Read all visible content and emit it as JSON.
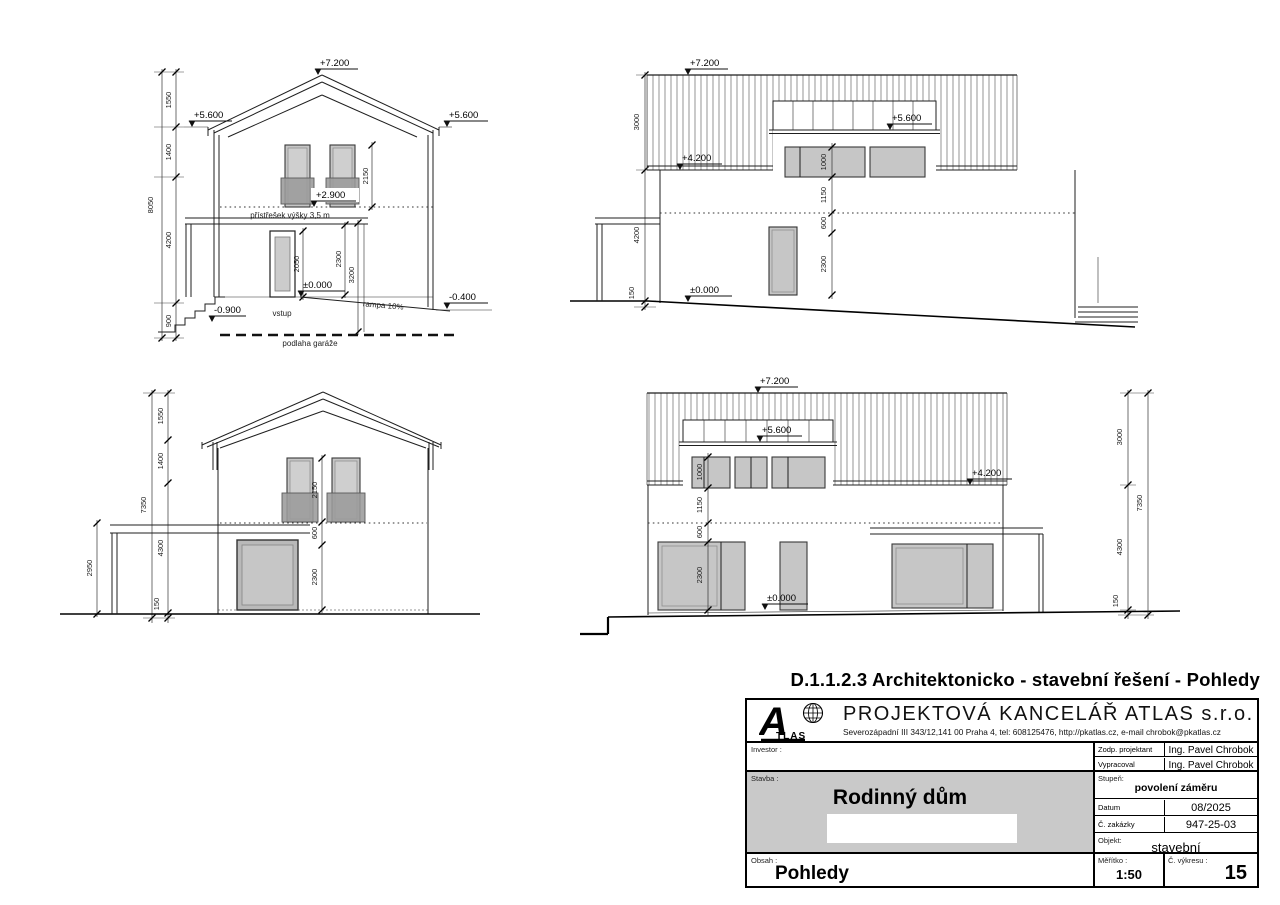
{
  "header": {
    "title": "D.1.1.2.3 Architektonicko - stavební řešení - Pohledy"
  },
  "views": {
    "front": {
      "levels": {
        "ridge": "+7.200",
        "eaves_left": "+5.600",
        "eaves_right": "+5.600",
        "balcony": "+2.900",
        "zero": "±0.000",
        "entry": "-0.900",
        "ramp_end": "-0.400"
      },
      "dims": {
        "overall": "8050",
        "chain": [
          "1550",
          "1400",
          "4200",
          "900"
        ],
        "window": "2150",
        "door": "2050",
        "opening": "2300",
        "ramp": "3200"
      },
      "labels": {
        "canopy": "přístřešek výšky 3,5 m",
        "entrance": "vstup",
        "ramp": "rampa 10%",
        "garage_floor": "podlaha garáže"
      }
    },
    "side_right": {
      "levels": {
        "ridge": "+7.200",
        "dormer": "+5.600",
        "eaves": "+4.200",
        "zero": "±0.000"
      },
      "dims": {
        "roof": "3000",
        "wall": "4200",
        "plinth": "150",
        "window": "1000",
        "parapet": "1150",
        "lintel": "600",
        "opening": "2300"
      }
    },
    "rear": {
      "dims": {
        "overall": "7350",
        "chain": [
          "1550",
          "1400",
          "4300",
          "150"
        ],
        "carport": "2950",
        "window": "2150",
        "lintel": "600",
        "opening": "2300"
      }
    },
    "side_left": {
      "levels": {
        "ridge": "+7.200",
        "dormer": "+5.600",
        "eaves": "+4.200",
        "zero": "±0.000"
      },
      "dims": {
        "roof": "3000",
        "overall": "7350",
        "wall": "4300",
        "plinth": "150",
        "window": "1000",
        "parapet": "1150",
        "lintel": "600",
        "opening": "2300"
      }
    }
  },
  "titleblock": {
    "company": "PROJEKTOVÁ  KANCELÁŘ ATLAS s.r.o.",
    "address": "Severozápadní III 343/12,141 00 Praha 4, tel: 608125476, http://pkatlas.cz, e-mail chrobok@pkatlas.cz",
    "logo": {
      "letter": "A",
      "rest": "TLAS"
    },
    "investor_label": "Investor :",
    "zodp_label": "Zodp. projektant",
    "zodp_value": "Ing. Pavel Chrobok",
    "vypracoval_label": "Vypracoval",
    "vypracoval_value": "Ing. Pavel Chrobok",
    "stavba_label": "Stavba :",
    "stavba_value": "Rodinný dům",
    "stupen_label": "Stupeň:",
    "stupen_value": "povolení záměru",
    "datum_label": "Datum",
    "datum_value": "08/2025",
    "zakazka_label": "Č. zakázky",
    "zakazka_value": "947-25-03",
    "objekt_label": "Objekt:",
    "objekt_value": "stavební",
    "obsah_label": "Obsah :",
    "obsah_value": "Pohledy",
    "meritko_label": "Měřítko :",
    "meritko_value": "1:50",
    "vykres_label": "Č. výkresu :",
    "vykres_value": "15"
  }
}
